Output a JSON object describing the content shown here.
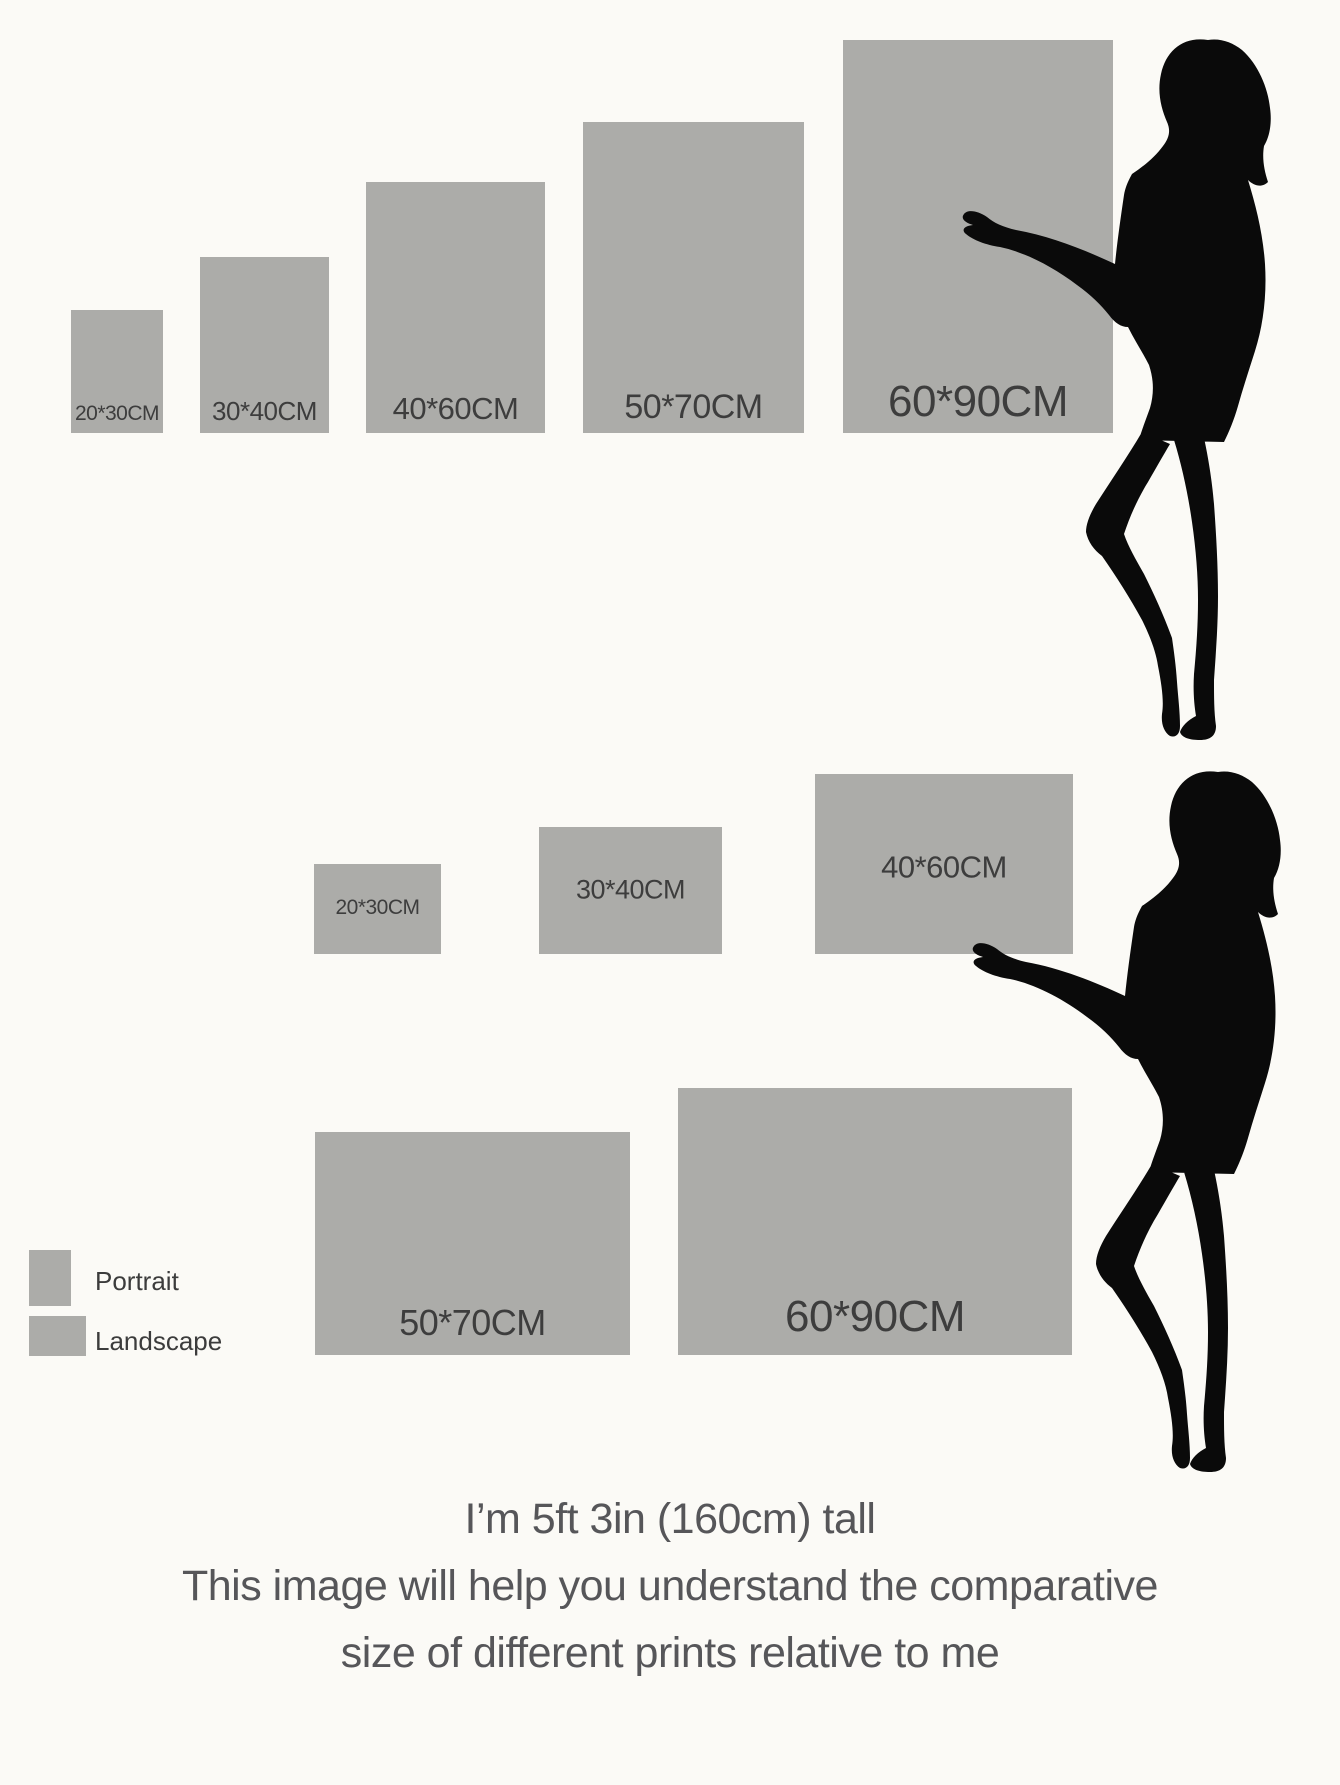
{
  "sections": {
    "portrait": {
      "labels": [
        "20*30CM",
        "30*40CM",
        "40*60CM",
        "50*70CM",
        "60*90CM"
      ]
    },
    "landscape": {
      "labels": [
        "20*30CM",
        "30*40CM",
        "40*60CM",
        "50*70CM",
        "60*90CM"
      ]
    }
  },
  "legend": {
    "portrait_label": "Portrait",
    "landscape_label": "Landscape"
  },
  "footer": {
    "line1": "I’m 5ft 3in (160cm) tall",
    "line2": "This image will help you understand the comparative",
    "line3": "size of different prints relative to me"
  },
  "icons": {
    "silhouette": "woman-silhouette"
  },
  "colors": {
    "background": "#fbfaf6",
    "print_rect": "#acaca9",
    "rect_label": "#3d3d3d",
    "silhouette": "#0a0a0a",
    "footer_text": "#565659",
    "legend_text": "#3c3c3c"
  }
}
